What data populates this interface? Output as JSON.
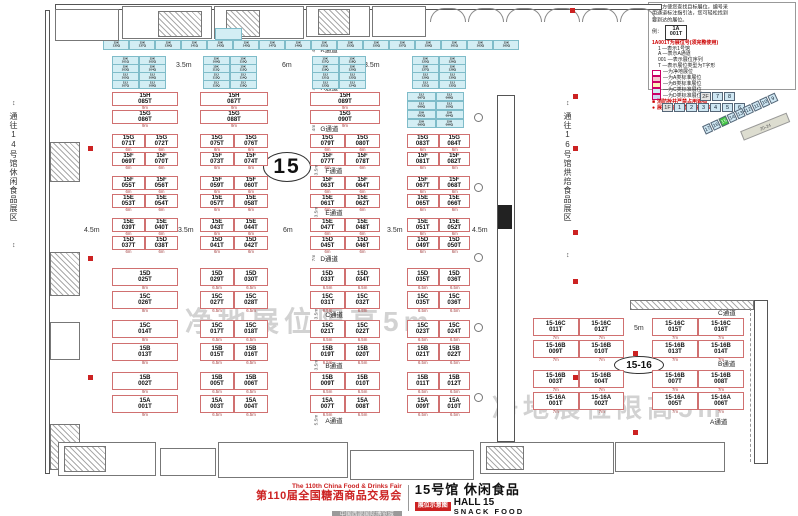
{
  "corridor_labels": {
    "left": "通往14号馆休闲食品展区",
    "right": "通往16号馆烘焙食品展区",
    "arrow": "↕"
  },
  "watermark": "净地展位限高5m",
  "legend": {
    "intro": [
      "为了方便您查找目标展位，编号采",
      "用通道标注指引法，您可轻松找到",
      "要到达的展位。"
    ],
    "example_prefix": "例：",
    "example": {
      "top": "1A",
      "bottom": "001T"
    },
    "subtitle": "1A001T为展位号(须完整使用)",
    "items": [
      "1 —表示1号馆",
      "A —表示A通道",
      "001 —表示展位序列",
      "T —表示展位类型为T字形"
    ],
    "key": [
      {
        "swatch": "#ffffff",
        "label": "—为净地展位"
      },
      {
        "swatch": "#f6c9d0",
        "label": "—为A类标准展位"
      },
      {
        "swatch": "#fdf1b8",
        "label": "—为B类标准展位"
      },
      {
        "swatch": "#cdeef4",
        "label": "—为C类标准展位"
      },
      {
        "swatch": "#ccd6f2",
        "label": "—为D类标准展位"
      }
    ],
    "notes": [
      {
        "icon": "■",
        "text": "消防栓井严禁占用遮挡"
      },
      {
        "icon": "●",
        "text": "展位内立柱 直径均为1.5m"
      }
    ]
  },
  "minimap": {
    "floor2_label": "2F",
    "floor1_label": "1F",
    "floor2_halls": [
      "7",
      "8"
    ],
    "floor1_halls": [
      "1",
      "2",
      "3",
      "4",
      "5",
      "6"
    ],
    "diagonal_halls": [
      "17",
      "16",
      "15",
      "14",
      "13",
      "12",
      "11",
      "10",
      "9"
    ],
    "highlight": "15",
    "annex_label": "20-24"
  },
  "main_hall": {
    "big_label": "15",
    "aisles": [
      {
        "name": "K通道",
        "width": "4m"
      },
      {
        "name": "H通道",
        "width": "4m"
      },
      {
        "name": "G通道",
        "width": "4m"
      },
      {
        "name": "F通道",
        "width": "3.5m"
      },
      {
        "name": "E通道",
        "width": "3.5m"
      },
      {
        "name": "D通道",
        "width": "7m"
      },
      {
        "name": "C通道",
        "width": "3.5m"
      },
      {
        "name": "B通道",
        "width": "3.5m"
      },
      {
        "name": "A通道",
        "width": "5.5m"
      }
    ],
    "dims_top": [
      "3.5m",
      "6m",
      "3.5m"
    ],
    "dims_mid": [
      "4.5m",
      "3.5m",
      "6m",
      "3.5m",
      "4.5m"
    ],
    "row_blocks": [
      {
        "dim": "6m",
        "wide_dim": "9m",
        "blocks": [
          {
            "top": [
              "15H 085T"
            ],
            "bottom": [
              "15G 086T"
            ]
          },
          {
            "top": [
              "15H 087T"
            ],
            "bottom": [
              "15G 088T"
            ]
          },
          {
            "top": [
              "15H 089T"
            ],
            "bottom": [
              "15G 090T"
            ]
          },
          {
            "mini": true
          }
        ]
      },
      {
        "dim": "6m",
        "blocks": [
          {
            "top": [
              "15G 071T",
              "15G 072T"
            ],
            "bottom": [
              "15F 069T",
              "15F 070T"
            ]
          },
          {
            "top": [
              "15G 075T",
              "15G 076T"
            ],
            "bottom": [
              "15F 073T",
              "15F 074T"
            ]
          },
          {
            "top": [
              "15G 079T",
              "15G 080T"
            ],
            "bottom": [
              "15F 077T",
              "15F 078T"
            ]
          },
          {
            "top": [
              "15G 083T",
              "15G 084T"
            ],
            "bottom": [
              "15F 081T",
              "15F 082T"
            ]
          }
        ]
      },
      {
        "dim": "6m",
        "blocks": [
          {
            "top": [
              "15F 055T",
              "15F 056T"
            ],
            "bottom": [
              "15E 053T",
              "15E 054T"
            ]
          },
          {
            "top": [
              "15F 059T",
              "15F 060T"
            ],
            "bottom": [
              "15E 057T",
              "15E 058T"
            ]
          },
          {
            "top": [
              "15F 063T",
              "15F 064T"
            ],
            "bottom": [
              "15E 061T",
              "15E 062T"
            ]
          },
          {
            "top": [
              "15F 067T",
              "15F 068T"
            ],
            "bottom": [
              "15E 065T",
              "15E 066T"
            ]
          }
        ]
      },
      {
        "dim": "6m",
        "blocks": [
          {
            "top": [
              "15E 039T",
              "15E 040T"
            ],
            "bottom": [
              "15D 037T",
              "15D 038T"
            ]
          },
          {
            "top": [
              "15E 043T",
              "15E 044T"
            ],
            "bottom": [
              "15D 041T",
              "15D 042T"
            ]
          },
          {
            "top": [
              "15E 047T",
              "15E 048T"
            ],
            "bottom": [
              "15D 045T",
              "15D 046T"
            ]
          },
          {
            "top": [
              "15E 051T",
              "15E 052T"
            ],
            "bottom": [
              "15D 049T",
              "15D 050T"
            ]
          }
        ]
      },
      {
        "dim": "6.5m",
        "wide_dim": "8m",
        "blocks": [
          {
            "top": [
              "15D 025T"
            ],
            "bottom": [
              "15C 026T"
            ]
          },
          {
            "top": [
              "15D 029T",
              "15D 030T"
            ],
            "bottom": [
              "15C 027T",
              "15C 028T"
            ]
          },
          {
            "top": [
              "15D 033T",
              "15D 034T"
            ],
            "bottom": [
              "15C 031T",
              "15C 032T"
            ]
          },
          {
            "top": [
              "15D 035T",
              "15D 036T"
            ],
            "bottom": [
              "15C 035T",
              "15C 036T"
            ]
          }
        ]
      },
      {
        "dim": "6.5m",
        "wide_dim": "8m",
        "blocks": [
          {
            "top": [
              "15C 014T"
            ],
            "bottom": [
              "15B 013T"
            ]
          },
          {
            "top": [
              "15C 017T",
              "15C 018T"
            ],
            "bottom": [
              "15B 015T",
              "15B 016T"
            ]
          },
          {
            "top": [
              "15C 021T",
              "15C 022T"
            ],
            "bottom": [
              "15B 019T",
              "15B 020T"
            ]
          },
          {
            "top": [
              "15C 023T",
              "15C 024T"
            ],
            "bottom": [
              "15B 021T",
              "15B 022T"
            ]
          }
        ]
      },
      {
        "dim": "6.5m",
        "wide_dim": "9m",
        "blocks": [
          {
            "top": [
              "15B 002T"
            ],
            "bottom": [
              "15A 001T"
            ]
          },
          {
            "top": [
              "15B 005T",
              "15B 006T"
            ],
            "bottom": [
              "15A 003T",
              "15A 004T"
            ]
          },
          {
            "top": [
              "15B 009T",
              "15B 010T"
            ],
            "bottom": [
              "15A 007T",
              "15A 008T"
            ]
          },
          {
            "top": [
              "15B 011T",
              "15B 012T"
            ],
            "bottom": [
              "15A 009T",
              "15A 010T"
            ]
          }
        ]
      }
    ],
    "mini_top_row": [
      "15K 135Q",
      "15K 137Q",
      "15K 139Q",
      "15K 141Q",
      "15K 143Q",
      "15K 145Q",
      "15K 147Q",
      "15K 149Q",
      "15K 151Q",
      "15K 153Q",
      "15K 155Q",
      "15K 157Q",
      "15K 159Q",
      "15K 161Q",
      "15K 163Q",
      "15K 165Q"
    ],
    "mini_groups": [
      [
        "15K 101Q",
        "15K 102Q",
        "15K 103Q",
        "15K 104Q",
        "15J 105Q",
        "15J 106Q",
        "15J 107Q",
        "15J 108Q"
      ],
      [
        "15K 109Q",
        "15K 110Q",
        "15K 111Q",
        "15K 112Q",
        "15J 113Q",
        "15J 114Q",
        "15J 115Q",
        "15J 116Q"
      ],
      [
        "15K 117Q",
        "15K 118Q",
        "15K 119Q",
        "15K 120Q",
        "15J 121Q",
        "15J 122Q",
        "15J 123Q",
        "15J 124Q"
      ],
      [
        "15K 125Q",
        "15K 126Q",
        "15K 127Q",
        "15K 128Q",
        "15J 129Q",
        "15J 130Q",
        "15J 131Q",
        "15J 132Q"
      ]
    ],
    "mini_block_hg": [
      "15J 097Q",
      "15J 098Q",
      "15J 099Q",
      "15J 100Q",
      "15H 093Q",
      "15H 094Q",
      "15H 095Q",
      "15H 096Q"
    ]
  },
  "annex_hall": {
    "big_label": "15-16",
    "aisles": [
      "C通道",
      "B通道",
      "A通道"
    ],
    "aisle_dim": "5m",
    "booth_dim": "7m",
    "rows_left": [
      [
        "15-16C 011T",
        "15-16C 012T"
      ],
      [
        "15-16B 009T",
        "15-16B 010T"
      ],
      [
        "15-16B 003T",
        "15-16B 004T"
      ],
      [
        "15-16A 001T",
        "15-16A 002T"
      ]
    ],
    "rows_right": [
      [
        "15-16C 015T",
        "15-16C 016T"
      ],
      [
        "15-16B 013T",
        "15-16B 014T"
      ],
      [
        "15-16B 007T",
        "15-16B 008T"
      ],
      [
        "15-16A 005T",
        "15-16A 006T"
      ]
    ]
  },
  "title_block": {
    "en_line": "The 110th China Food & Drinks Fair",
    "cn_line": "第110届全国糖酒商品交易会",
    "venue": "中国西部国际博览城",
    "hall_cn": "15号馆 休闲食品",
    "hall_en": "HALL 15",
    "hall_sub": "SNACK FOOD",
    "badge": "展位示意图"
  }
}
